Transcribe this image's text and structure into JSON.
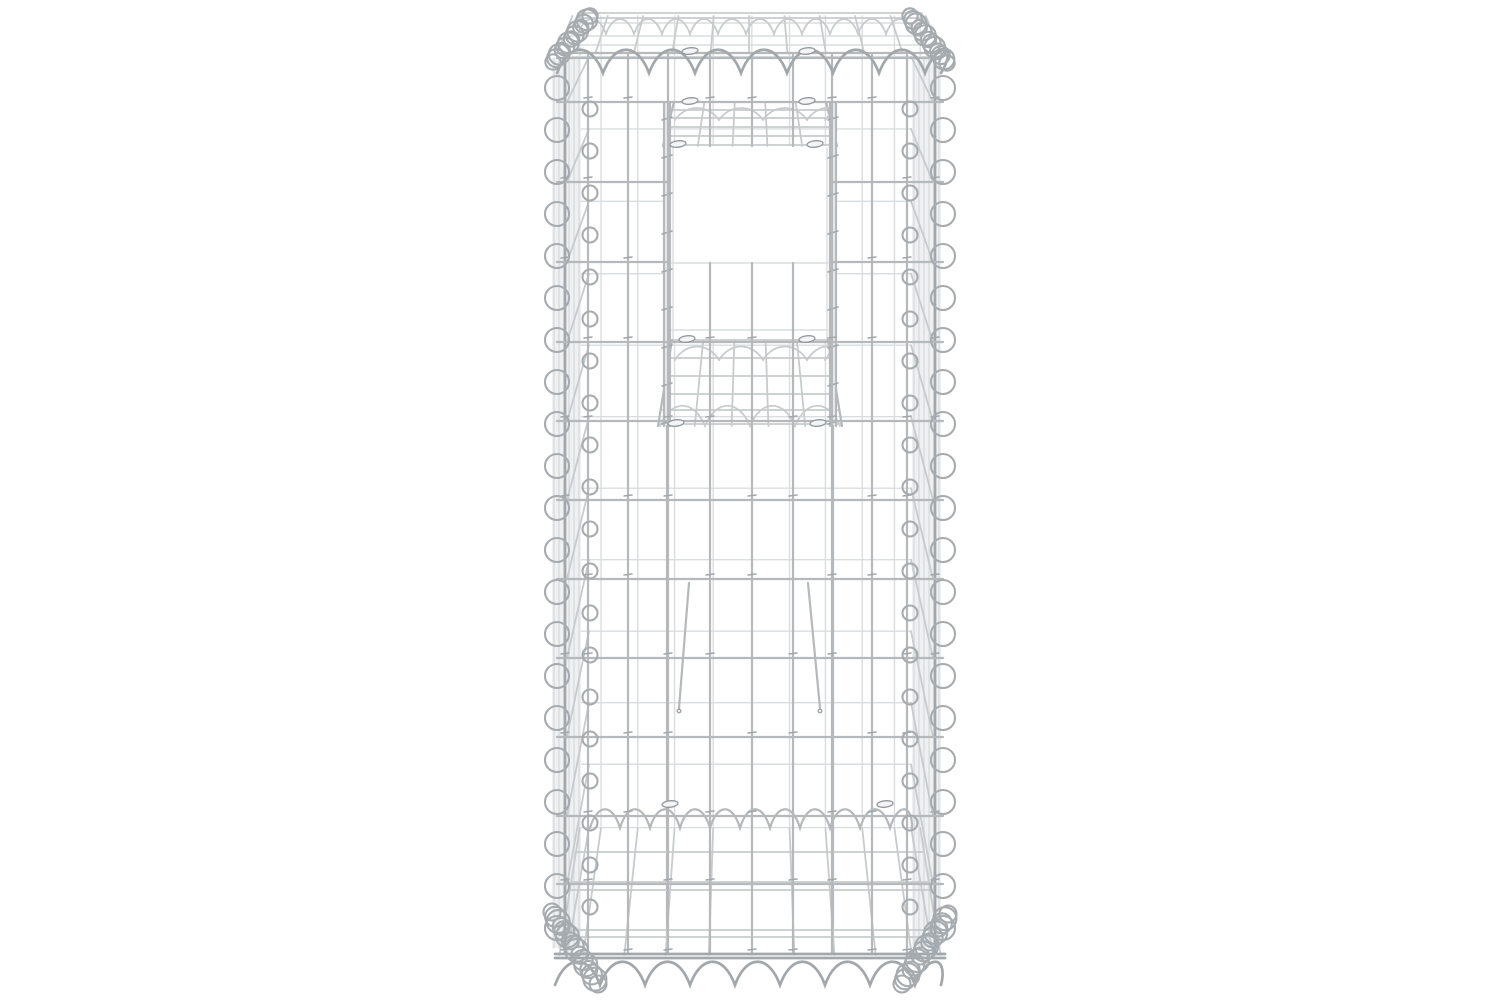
{
  "meta": {
    "kind": "product_photo",
    "description": "Front view of a tall silver galvanised-steel gabion basket post (wire mesh pillar) with a square tunnel opening in its upper half, spiral-wire bound edges, shown on a seamless pure white background. No text, UI or watermark is visible.",
    "canvas": {
      "width": 1500,
      "height": 1000
    },
    "background": "#ffffff"
  },
  "palette": {
    "bg": "#ffffff",
    "wire_faint": "#dadddf",
    "wire_mid": "#c7cbcd",
    "wire_main": "#b5b9bc",
    "wire_dark": "#a1a7ab",
    "wire_coil": "#a5abaf",
    "clip_fill": "#f3f4f5",
    "clip_stroke": "#92989c",
    "rail_fill": "#e9ebec",
    "hatch_fill": "#eef0f1"
  },
  "object": {
    "name": "gabion-basket-post",
    "material": "galvanised steel wire",
    "center_x": 750,
    "front": {
      "left": 565,
      "right": 935,
      "top": 55,
      "bottom": 954,
      "verticals": [
        565,
        588,
        628,
        668,
        710,
        752,
        793,
        832,
        872,
        907,
        935
      ],
      "horizontals": [
        102,
        182,
        262,
        342,
        421,
        500,
        579,
        658,
        737,
        816,
        884,
        954
      ],
      "rail_x": [
        667,
        833
      ],
      "window_cut_verticals": [
        710,
        752,
        793
      ]
    },
    "back": {
      "scale_x": 0.92,
      "y_at_front_top": 14,
      "y_slope": 0.905,
      "v_top": 16,
      "v_bottom": 826
    },
    "top_face": {
      "back_rim_y": [
        13,
        18
      ],
      "back_x": [
        578,
        922
      ],
      "front_rim_y": [
        53,
        58
      ],
      "front_x": [
        557,
        941
      ],
      "lateral_y": [
        23,
        36,
        45
      ],
      "vertical_count": 11
    },
    "helix_top_back": {
      "x1": 578,
      "x2": 922,
      "y_top": 14,
      "y_bottom": 34,
      "period": 28
    },
    "helix_top_front": {
      "x1": 557,
      "x2": 941,
      "y_top": 42,
      "y_bottom": 73,
      "period": 46
    },
    "helix_inner": {
      "x1": 590,
      "x2": 912,
      "y_top": 803,
      "y_bottom": 828,
      "period": 30
    },
    "helix_bottom": {
      "x1": 555,
      "x2": 941,
      "y_top": 954,
      "y_bottom": 985,
      "period": 45
    },
    "window": {
      "x1": 669,
      "y1": 146,
      "x2": 831,
      "y2": 341,
      "inner_h": [
        263,
        330
      ],
      "inner_v_top": 263
    },
    "ceiling_shelf": {
      "xb": [
        674,
        826
      ],
      "yb": 102,
      "xf": [
        663,
        837
      ],
      "yf": 146,
      "h_lines": [
        102,
        110,
        118,
        127,
        136,
        145
      ],
      "v_div": 5,
      "zigzag": {
        "x1": 675,
        "x2": 825,
        "y_top": 104,
        "y_bottom": 120,
        "period": 44
      }
    },
    "floor_shelf": {
      "xb": [
        672,
        828
      ],
      "yb": 340,
      "xf": [
        658,
        842
      ],
      "yf": 426,
      "h_lines": [
        340,
        358,
        376,
        394,
        410,
        424
      ],
      "v_div": 5,
      "zigzag_back": {
        "x1": 675,
        "x2": 825,
        "y_top": 342,
        "y_bottom": 360,
        "period": 44
      },
      "zigzag_front": {
        "x1": 660,
        "x2": 840,
        "y_top": 399,
        "y_bottom": 426,
        "period": 45
      }
    },
    "rails": {
      "y1": 102,
      "y2": 954,
      "heavy_to": 426,
      "band_w": 7
    },
    "hook_wires": [
      [
        689,
        583,
        679,
        708
      ],
      [
        808,
        583,
        820,
        708
      ]
    ],
    "bottom_basket": {
      "y_back": 828,
      "y_front": 955,
      "scale_top": 0.92,
      "scale_bottom": 1.03,
      "laterals": [
        852,
        882,
        890,
        930,
        937
      ]
    },
    "bottom_rim_y": [
      954,
      958
    ],
    "side_left": {
      "hatch_x1": 552,
      "hatch_x2": 581,
      "hatch_lines": 6,
      "front_edge_x": 567,
      "back_edge_x": 589,
      "loops_big_x": 557,
      "loops_big_r": 12,
      "loops_small_x": 590,
      "loops_small_r": 7.5
    },
    "side_right": {
      "hatch_x1": 912,
      "hatch_x2": 941,
      "hatch_lines": 6,
      "front_edge_x": 933,
      "back_edge_x": 911,
      "loops_big_x": 943,
      "loops_big_r": 12,
      "loops_small_x": 910,
      "loops_small_r": 7.5
    },
    "loops": {
      "start_y": 88,
      "step": 42,
      "count": 21,
      "small_offset": 21
    },
    "corner_coils": {
      "top_left": {
        "a": [
          553,
          62
        ],
        "b": [
          590,
          16
        ],
        "n": 13,
        "r": 9
      },
      "top_right": {
        "a": [
          910,
          16
        ],
        "b": [
          947,
          63
        ],
        "n": 13,
        "r": 9
      },
      "bottom_left": {
        "a": [
          552,
          912
        ],
        "b": [
          598,
          984
        ],
        "n": 16,
        "r": 10
      },
      "bottom_right": {
        "a": [
          902,
          984
        ],
        "b": [
          948,
          914
        ],
        "n": 16,
        "r": 10
      }
    },
    "clips": [
      [
        690,
        51
      ],
      [
        807,
        51
      ],
      [
        690,
        101
      ],
      [
        807,
        101
      ],
      [
        678,
        144
      ],
      [
        815,
        144
      ],
      [
        687,
        339
      ],
      [
        807,
        339
      ],
      [
        676,
        423
      ],
      [
        818,
        423
      ],
      [
        670,
        804
      ],
      [
        885,
        804
      ]
    ]
  }
}
